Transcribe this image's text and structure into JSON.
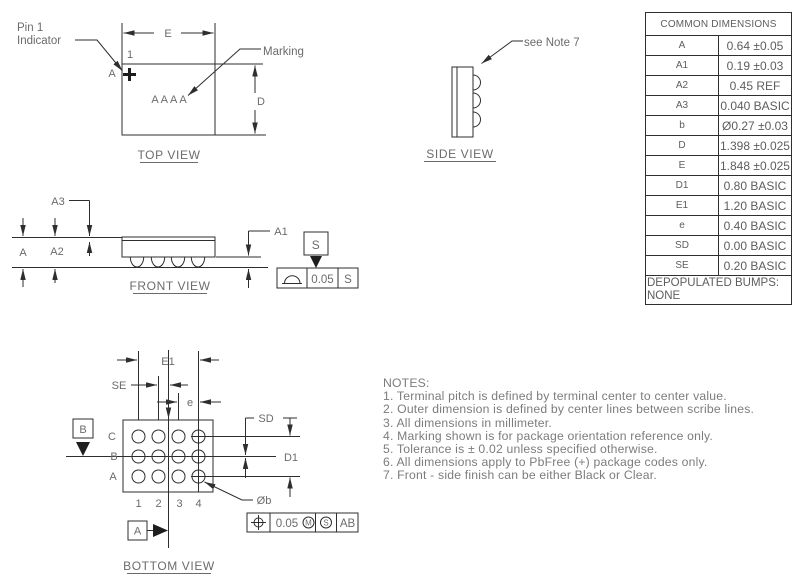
{
  "top_view": {
    "title": "TOP VIEW",
    "pin1_line1": "Pin 1",
    "pin1_line2": "Indicator",
    "pin_number": "1",
    "corner_datum": "A",
    "marking": "AAAA",
    "marking_label": "Marking",
    "dim_e": "E",
    "dim_d": "D"
  },
  "side_view": {
    "title": "SIDE VIEW",
    "note": "see Note 7"
  },
  "front_view": {
    "title": "FRONT VIEW",
    "dim_a": "A",
    "dim_a1": "A1",
    "dim_a2": "A2",
    "dim_a3": "A3",
    "datum_s": "S",
    "fcf": {
      "tol": "0.05",
      "datum": "S"
    }
  },
  "bottom_view": {
    "title": "BOTTOM VIEW",
    "dim_e1": "E1",
    "dim_se": "SE",
    "dim_e": "e",
    "dim_sd": "SD",
    "dim_d1": "D1",
    "dim_ob": "Øb",
    "rows": [
      "C",
      "B",
      "A"
    ],
    "cols": [
      "1",
      "2",
      "3",
      "4"
    ],
    "datum_a": "A",
    "datum_b": "B",
    "fcf": {
      "tol": "0.05",
      "mod1": "M",
      "mod2": "S",
      "datums": "AB"
    }
  },
  "table": {
    "header": "COMMON DIMENSIONS",
    "rows": [
      {
        "sym": "A",
        "val": "0.64 ±0.05"
      },
      {
        "sym": "A1",
        "val": "0.19 ±0.03"
      },
      {
        "sym": "A2",
        "val": "0.45 REF"
      },
      {
        "sym": "A3",
        "val": "0.040 BASIC"
      },
      {
        "sym": "b",
        "val": "Ø0.27 ±0.03"
      },
      {
        "sym": "D",
        "val": "1.398 ±0.025"
      },
      {
        "sym": "E",
        "val": "1.848 ±0.025"
      },
      {
        "sym": "D1",
        "val": "0.80 BASIC"
      },
      {
        "sym": "E1",
        "val": "1.20 BASIC"
      },
      {
        "sym": "e",
        "val": "0.40 BASIC"
      },
      {
        "sym": "SD",
        "val": "0.00 BASIC"
      },
      {
        "sym": "SE",
        "val": "0.20 BASIC"
      }
    ],
    "footer1": "DEPOPULATED BUMPS:",
    "footer2": "NONE"
  },
  "notes": {
    "heading": "NOTES:",
    "items": [
      "1. Terminal pitch is defined by terminal center to center value.",
      "2. Outer dimension is defined by center lines between scribe lines.",
      "3. All dimensions in millimeter.",
      "4. Marking shown is for package orientation reference only.",
      "5. Tolerance is ± 0.02 unless specified otherwise.",
      "6. All dimensions apply to PbFree (+) package codes only.",
      "7. Front - side finish can be either Black or Clear."
    ]
  },
  "colors": {
    "line": "#2e2e2e",
    "text": "#6b6b6b"
  }
}
